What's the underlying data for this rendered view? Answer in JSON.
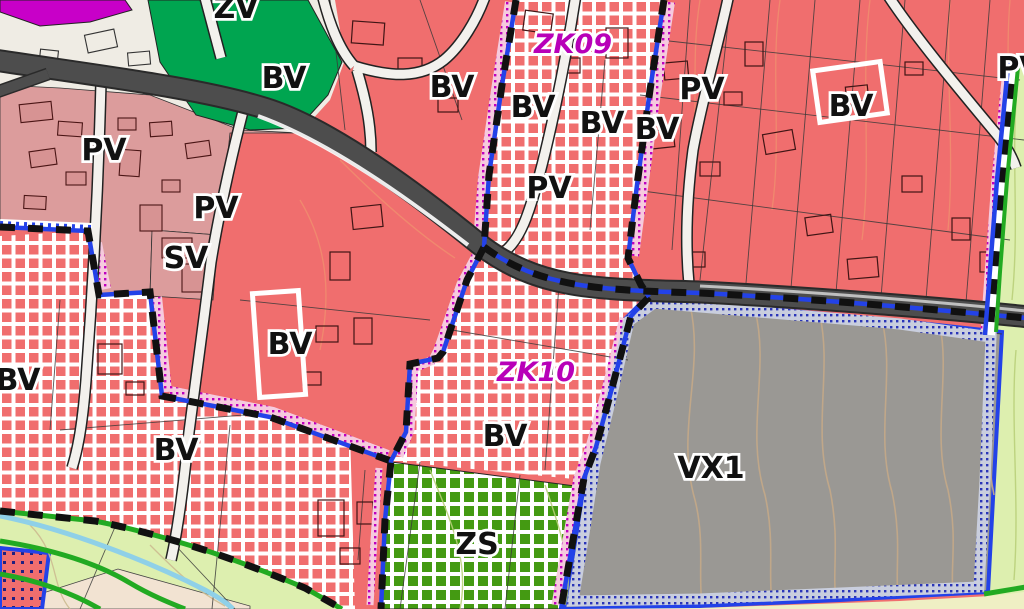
{
  "map": {
    "type": "zoning-plan-map",
    "labels": [
      {
        "text": "ZV",
        "x": 236,
        "y": 18,
        "kind": "zone"
      },
      {
        "text": "BV",
        "x": 284,
        "y": 88,
        "kind": "zone"
      },
      {
        "text": "BV",
        "x": 452,
        "y": 97,
        "kind": "zone"
      },
      {
        "text": "PV",
        "x": 104,
        "y": 160,
        "kind": "zone"
      },
      {
        "text": "PV",
        "x": 216,
        "y": 218,
        "kind": "zone"
      },
      {
        "text": "SV",
        "x": 186,
        "y": 268,
        "kind": "zone"
      },
      {
        "text": "BV",
        "x": 290,
        "y": 354,
        "kind": "zone"
      },
      {
        "text": "BV",
        "x": 18,
        "y": 390,
        "kind": "zone"
      },
      {
        "text": "BV",
        "x": 176,
        "y": 460,
        "kind": "zone"
      },
      {
        "text": "ZK09",
        "x": 573,
        "y": 53,
        "kind": "zk"
      },
      {
        "text": "BV",
        "x": 533,
        "y": 117,
        "kind": "zone"
      },
      {
        "text": "BV",
        "x": 602,
        "y": 133,
        "kind": "zone"
      },
      {
        "text": "PV",
        "x": 549,
        "y": 198,
        "kind": "zone"
      },
      {
        "text": "PV",
        "x": 702,
        "y": 99,
        "kind": "zone"
      },
      {
        "text": "BV",
        "x": 657,
        "y": 139,
        "kind": "zone"
      },
      {
        "text": "BV",
        "x": 851,
        "y": 116,
        "kind": "zone"
      },
      {
        "text": "PV",
        "x": 1020,
        "y": 78,
        "kind": "zone"
      },
      {
        "text": "ZK10",
        "x": 536,
        "y": 381,
        "kind": "zk"
      },
      {
        "text": "BV",
        "x": 505,
        "y": 446,
        "kind": "zone"
      },
      {
        "text": "VX1",
        "x": 711,
        "y": 478,
        "kind": "zone"
      },
      {
        "text": "ZS",
        "x": 477,
        "y": 554,
        "kind": "zone"
      }
    ],
    "colors": {
      "zone_red": "#F06E6E",
      "zone_pink": "#DC9C9C",
      "zone_green": "#00A550",
      "zone_magenta": "#C800C8",
      "zone_gray": "#9A9894",
      "zone_palegreen": "#DDEFAF",
      "zone_beige": "#F2E3D2",
      "zone_yellow": "#EFEFC4",
      "zone_cream": "#EFECE4",
      "checker_red": "#F06E6E",
      "checker_green": "#449A12",
      "road_dark": "#4D4D4D",
      "road_white": "#F3F1ED",
      "boundary_black": "#111111",
      "boundary_blue": "#2342E8",
      "dots_magenta": "#BE00BE",
      "dots_blue": "#2A35B8",
      "green_line": "#22AA22",
      "stream": "#8FD0E8",
      "contour_tan": "#C2A888",
      "label_black": "#111111",
      "label_magenta": "#B800B8"
    }
  }
}
